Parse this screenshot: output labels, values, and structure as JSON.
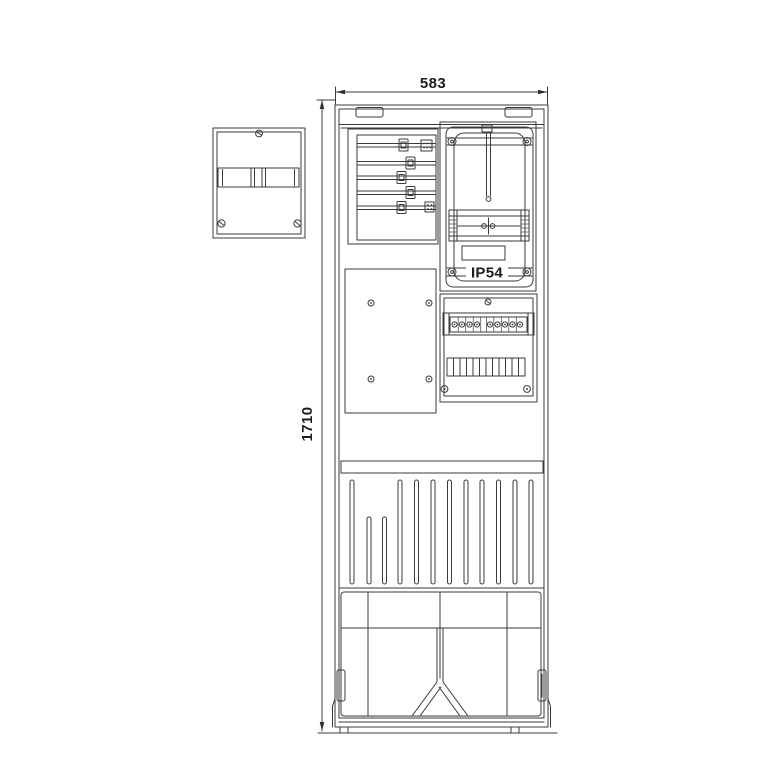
{
  "diagram": {
    "type": "technical-drawing",
    "subject": "electrical meter distribution cabinet, front view with auxiliary enclosure",
    "dimensions": {
      "width_label": "583",
      "height_label": "1710"
    },
    "labels": {
      "ip_rating": "IP54"
    },
    "colors": {
      "line": "#3a3a3a",
      "background": "#ffffff",
      "text": "#1c1c1c"
    }
  }
}
